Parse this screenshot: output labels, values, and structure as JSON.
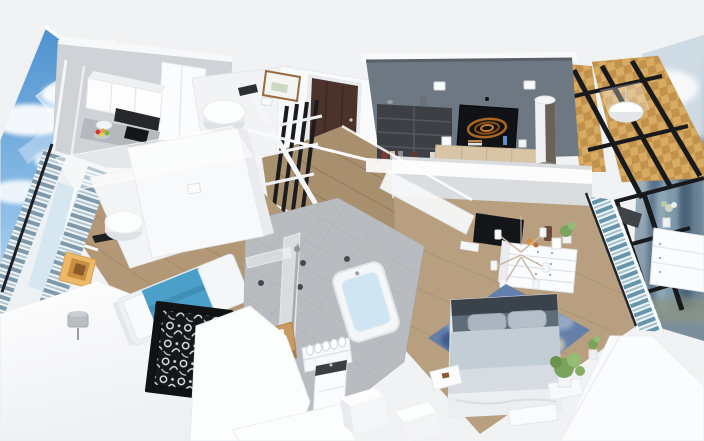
{
  "app": {
    "view_title": "3d-apartment-floorplan-render",
    "view_style": "axonometric cutaway with translucent white walls"
  },
  "palette": {
    "background": "#f1f2f3",
    "wall_white": "#fdfdfe",
    "wall_shade": "#e8eaed",
    "kitchen_wall": "#cfd3d7",
    "accent_wall": "#6e7882",
    "wood_floor": "#a8906e",
    "wood_floor_light": "#b79f80",
    "balcony_wood": "#d7ab62",
    "balcony_wood_dark": "#c2914c",
    "door_brown": "#4b322b",
    "frame_black": "#17191c",
    "glass_blue": "#d7e7f2",
    "curtain_blue": "#7d99ab",
    "curtain_teal": "#5f8fa6",
    "bed_blanket": "#4aa0c9",
    "bedding_light": "#c3cdd6",
    "headboard": "#3a434c",
    "rug_blue": "#5f7dab",
    "tub_water": "#cfe5f1",
    "tile_gray": "#b8bcc0",
    "tv_screen": "#101216",
    "tv_art_orange": "#b06a22",
    "art_frame": "#ecb869",
    "sideboard": "#d8c5a5",
    "shelf_unit": "#3c4045",
    "lamp_metal": "#6a6157",
    "sky_top": "#4f92cf",
    "cloud": "#ffffff",
    "city_haze": "#a9b8c2",
    "plant": "#7aa45e",
    "stool_wood": "#c79a61",
    "vanity_top": "#3b3f43"
  },
  "backdrops": {
    "left_panel": "sky-clouds-over-city-photo",
    "right_panel": "city-skyline-photo"
  },
  "rooms": [
    {
      "name": "kitchen",
      "items": [
        "upper-cabinets",
        "range-hood",
        "cooktop",
        "countertop",
        "sink",
        "fruit-bowl",
        "tall-cabinet"
      ]
    },
    {
      "name": "bedroom-left",
      "items": [
        "double-bed-blue",
        "window-curtains-blue",
        "orange-frame-art",
        "decorative-screen",
        "ceiling-cylinder-lamp",
        "bedside-lamp"
      ]
    },
    {
      "name": "entry-hall",
      "items": [
        "front-door",
        "glass-partition",
        "ceiling-cylinder-lamp",
        "wall-picture",
        "wood-floor"
      ]
    },
    {
      "name": "bathroom",
      "items": [
        "bathtub",
        "shower-set",
        "glass-screen",
        "wooden-stool",
        "towel-shelf",
        "vanity-basin",
        "ceiling-spotlights"
      ]
    },
    {
      "name": "living-room",
      "items": [
        "dark-accent-wall",
        "media-shelf",
        "tv-with-orange-art",
        "wood-sideboard",
        "cylinder-floor-lamp",
        "ceiling-spotlights"
      ]
    },
    {
      "name": "bedroom-master",
      "items": [
        "wall-tv",
        "white-dresser",
        "branch-chandelier",
        "double-bed-gray",
        "blue-area-rug",
        "benches",
        "potted-plants",
        "teal-window-curtains",
        "side-dresser"
      ]
    },
    {
      "name": "balcony",
      "items": [
        "checkered-parquet-floor",
        "black-window-grid",
        "pendant-lamp"
      ]
    }
  ]
}
